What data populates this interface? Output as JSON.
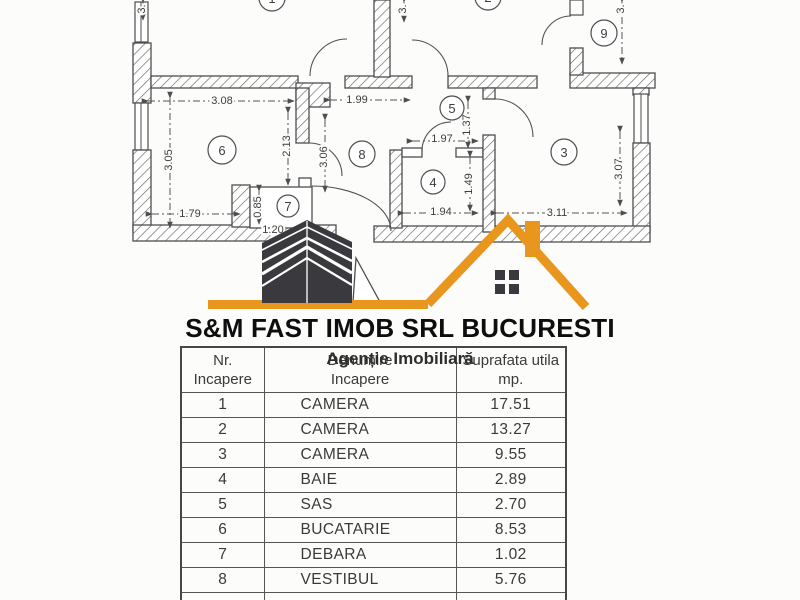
{
  "logo": {
    "company": "S&M FAST IMOB SRL BUCURESTI",
    "tagline": "Agenție Imobiliară",
    "accent_color": "#E8961E",
    "building_color": "#3A3A3E"
  },
  "plan": {
    "rooms": [
      {
        "num": "1",
        "cx": 272,
        "cy": -2,
        "r": 13
      },
      {
        "num": "2",
        "cx": 488,
        "cy": -3,
        "r": 13
      },
      {
        "num": "9",
        "cx": 604,
        "cy": 33,
        "r": 13
      },
      {
        "num": "6",
        "cx": 222,
        "cy": 150,
        "r": 14
      },
      {
        "num": "7",
        "cx": 288,
        "cy": 206,
        "r": 11
      },
      {
        "num": "8",
        "cx": 362,
        "cy": 154,
        "r": 13
      },
      {
        "num": "5",
        "cx": 452,
        "cy": 108,
        "r": 12
      },
      {
        "num": "4",
        "cx": 433,
        "cy": 182,
        "r": 12
      },
      {
        "num": "3",
        "cx": 564,
        "cy": 152,
        "r": 13
      }
    ],
    "dimensions": [
      {
        "label": "3.08",
        "x1": 148,
        "y1": 101,
        "x2": 294,
        "y2": 101,
        "tx": 222,
        "ty": 101
      },
      {
        "label": "1.99",
        "x1": 330,
        "y1": 100,
        "x2": 410,
        "y2": 100,
        "tx": 357,
        "ty": 100
      },
      {
        "label": "3.05",
        "x1": 170,
        "y1": 98,
        "x2": 170,
        "y2": 228,
        "tx": 169,
        "ty": 160,
        "rot": -90
      },
      {
        "label": "2.13",
        "x1": 288,
        "y1": 113,
        "x2": 288,
        "y2": 185,
        "tx": 287,
        "ty": 146,
        "rot": -90
      },
      {
        "label": "3.06",
        "x1": 325,
        "y1": 120,
        "x2": 325,
        "y2": 192,
        "tx": 324,
        "ty": 157,
        "rot": -90
      },
      {
        "label": "1.79",
        "x1": 152,
        "y1": 214,
        "x2": 240,
        "y2": 214,
        "tx": 190,
        "ty": 214
      },
      {
        "label": "0.85",
        "x1": 259,
        "y1": 191,
        "x2": 259,
        "y2": 224,
        "tx": 258,
        "ty": 207,
        "rot": -90
      },
      {
        "label": "1.20",
        "tx": 273,
        "ty": 230
      },
      {
        "label": "1.97",
        "x1": 413,
        "y1": 141,
        "x2": 478,
        "y2": 141,
        "tx": 442,
        "ty": 139
      },
      {
        "label": "1.37",
        "x1": 468,
        "y1": 102,
        "x2": 468,
        "y2": 148,
        "tx": 467,
        "ty": 125,
        "rot": -90
      },
      {
        "label": "1.94",
        "x1": 404,
        "y1": 213,
        "x2": 478,
        "y2": 213,
        "tx": 441,
        "ty": 212
      },
      {
        "label": "1.49",
        "x1": 470,
        "y1": 157,
        "x2": 470,
        "y2": 211,
        "tx": 469,
        "ty": 184,
        "rot": -90
      },
      {
        "label": "3.11",
        "x1": 497,
        "y1": 213,
        "x2": 627,
        "y2": 213,
        "tx": 557,
        "ty": 213
      },
      {
        "label": "3.07",
        "x1": 620,
        "y1": 132,
        "x2": 620,
        "y2": 206,
        "tx": 619,
        "ty": 169,
        "rot": -90
      },
      {
        "label": "3.",
        "x1": 143,
        "y1": 2,
        "x2": 143,
        "y2": 20,
        "tx": 142,
        "ty": 9,
        "rot": -90
      },
      {
        "label": "3.",
        "x1": 404,
        "y1": 2,
        "x2": 404,
        "y2": 22,
        "tx": 403,
        "ty": 9,
        "rot": -90
      },
      {
        "label": "3.",
        "x1": 622,
        "y1": 2,
        "x2": 622,
        "y2": 64,
        "tx": 621,
        "ty": 9,
        "rot": -90
      }
    ]
  },
  "table": {
    "headers": {
      "col1_line1": "Nr.",
      "col1_line2": "Incapere",
      "col2_line1": "Denumire",
      "col2_line2": "Incapere",
      "col3_line1": "Suprafata utila",
      "col3_line2": "mp."
    },
    "rows": [
      {
        "nr": "1",
        "name": "CAMERA",
        "area": "17.51"
      },
      {
        "nr": "2",
        "name": "CAMERA",
        "area": "13.27"
      },
      {
        "nr": "3",
        "name": "CAMERA",
        "area": "9.55"
      },
      {
        "nr": "4",
        "name": "BAIE",
        "area": "2.89"
      },
      {
        "nr": "5",
        "name": "SAS",
        "area": "2.70"
      },
      {
        "nr": "6",
        "name": "BUCATARIE",
        "area": "8.53"
      },
      {
        "nr": "7",
        "name": "DEBARA",
        "area": "1.02"
      },
      {
        "nr": "8",
        "name": "VESTIBUL",
        "area": "5.76"
      },
      {
        "nr": "",
        "name": "",
        "area": ""
      }
    ]
  }
}
